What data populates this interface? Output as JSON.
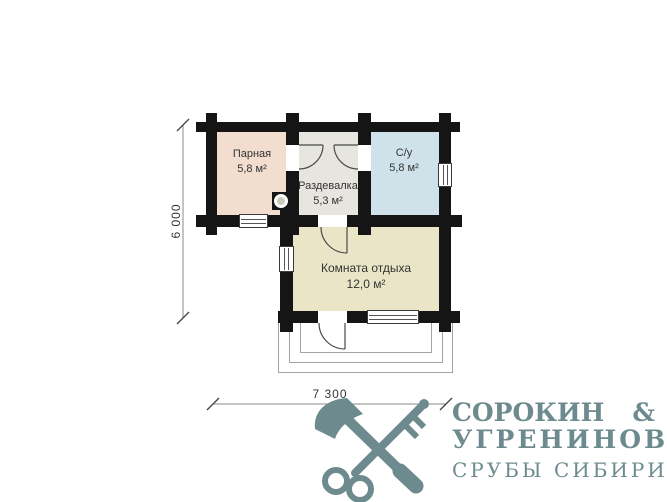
{
  "plan": {
    "rooms": [
      {
        "id": "parnaya",
        "name": "Парная",
        "area": "5,8 м²"
      },
      {
        "id": "razdevalka",
        "name": "Раздевалка",
        "area": "5,3 м²"
      },
      {
        "id": "su",
        "name": "С/у",
        "area": "5,8 м²"
      },
      {
        "id": "komnata",
        "name": "Комната отдыха",
        "area": "12,0 м²"
      }
    ],
    "dimensions": {
      "height_label": "6 000",
      "width_label": "7 300"
    },
    "colors": {
      "wall": "#151515",
      "parnaya": "#f2ddce",
      "razdevalka": "#e7e5df",
      "su": "#cfe2e9",
      "komnata": "#ebe5c7"
    }
  },
  "logo": {
    "name_left": "СОРОКИН",
    "ampersand": "&",
    "name_second": "УГРЕНИНОВ",
    "tagline": "СРУБЫ СИБИРИ",
    "color": "#6d8b8e"
  }
}
